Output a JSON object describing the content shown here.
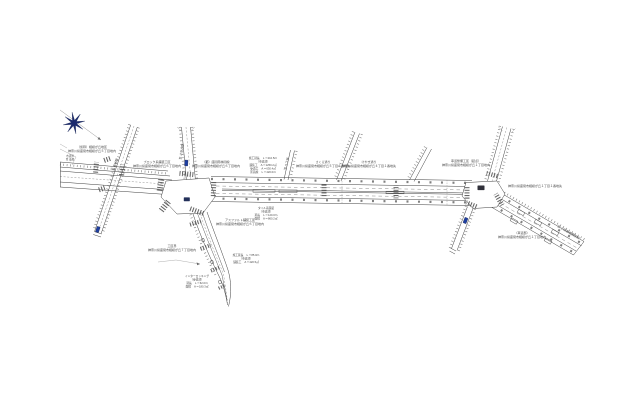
{
  "colors": {
    "background": "#ffffff",
    "line": "#3f3f3f",
    "navy": "#1b2a6e",
    "sign_blue": "#1e3fa0",
    "text": "#474747"
  },
  "compass": {
    "icon": "north-star-compass-icon"
  },
  "labels": [
    {
      "id": "plan-note-northwest",
      "x": 92,
      "y": 148,
      "lines": [
        "（仮称）相模が丘地区",
        "神奈川県座間市相模が丘５丁目地内"
      ]
    },
    {
      "id": "label-west-block",
      "x": 157,
      "y": 163,
      "lines": [
        "ブロック系舗装工区",
        "神奈川県座間市相模が丘６丁目地内"
      ]
    },
    {
      "id": "label-north-approach",
      "x": 216,
      "y": 163,
      "lines": [
        "（都）座間南林間線",
        "神奈川県座間市相模が丘６丁目地内"
      ]
    },
    {
      "id": "works-summary-center",
      "x": 263,
      "y": 159,
      "size": 2.7,
      "lines": [
        "施工延長　Ｌ＝210.5ｍ",
        "（車道部）",
        "舗装工　Ａ＝1250.2㎡",
        "歩道工　Ａ＝630.4㎡",
        "区画線　Ｌ＝420.0ｍ"
      ]
    },
    {
      "id": "label-branch-sakura",
      "x": 323,
      "y": 163,
      "lines": [
        "さくら通り",
        "神奈川県座間市相模が丘５丁目６番地先"
      ]
    },
    {
      "id": "label-branch-keyaki",
      "x": 369,
      "y": 163,
      "lines": [
        "けやき通り",
        "神奈川県座間市相模が丘４丁目１番地先"
      ]
    },
    {
      "id": "label-east-works",
      "x": 466,
      "y": 162,
      "lines": [
        "車道整備工区（起点）",
        "神奈川県座間市相模が丘１丁目地内"
      ]
    },
    {
      "id": "label-east-address",
      "x": 508,
      "y": 187,
      "anchor": "start",
      "lines": [
        "神奈川県座間市相模が丘１丁目１番地先"
      ]
    },
    {
      "id": "label-se-road",
      "x": 522,
      "y": 234,
      "lines": [
        "（車道部）",
        "神奈川県座間市相模が丘１丁目地内"
      ]
    },
    {
      "id": "dest-se",
      "x": 568,
      "y": 233,
      "rotate": 30,
      "lines": [
        "至 小田急相模原駅"
      ]
    },
    {
      "id": "label-ward-boundary",
      "x": 172,
      "y": 247,
      "lines": [
        "工区界",
        "神奈川県座間市相模が丘７丁目地内"
      ]
    },
    {
      "id": "works-summary-south-east",
      "x": 246,
      "y": 256,
      "size": 2.7,
      "lines": [
        "施工延長　Ｌ＝85.0ｍ",
        "（車道部）",
        "舗装工　Ａ＝420.5㎡"
      ]
    },
    {
      "id": "works-summary-south-west",
      "x": 197,
      "y": 277,
      "size": 2.7,
      "lines": [
        "インターロッキング",
        "（歩道部）",
        "延長　Ｌ＝62.0ｍ",
        "面積　Ａ＝180.3㎡"
      ]
    },
    {
      "id": "works-summary-below-road",
      "x": 266,
      "y": 209,
      "size": 2.7,
      "lines": [
        "タイル系舗装",
        "（車道部）",
        "延長　Ｌ＝120.0ｍ",
        "面積　Ａ＝860.2㎡"
      ]
    },
    {
      "id": "label-asphalt-works",
      "x": 240,
      "y": 221,
      "lines": [
        "アスファルト舗装工区",
        "神奈川県座間市相模が丘６丁目地内"
      ]
    },
    {
      "id": "dest-north-approach",
      "x": 182.5,
      "y": 152,
      "rotate": -80,
      "lines": [
        "至 さがみ野"
      ]
    },
    {
      "id": "dest-branch-1",
      "x": 287.5,
      "y": 164,
      "rotate": -77,
      "lines": [
        "至 ５丁目"
      ]
    },
    {
      "id": "dest-left-road",
      "x": 116,
      "y": 165,
      "rotate": -71,
      "lines": [
        "至 東林間"
      ]
    },
    {
      "id": "label-left-stub",
      "x": 70,
      "y": 157,
      "size": 2.6,
      "lines": [
        "市道界",
        "至 東原"
      ]
    }
  ],
  "markers": {
    "sign_posts": [
      {
        "x": 186.3,
        "y": 163,
        "rotate": 4
      },
      {
        "x": 97.8,
        "y": 229.5,
        "rotate": 19
      },
      {
        "x": 465.5,
        "y": 220.5,
        "rotate": 21
      }
    ],
    "signal_plates": [
      {
        "x": 186.8,
        "y": 199.3,
        "w": 6,
        "h": 3.8,
        "color": "#23305a"
      },
      {
        "x": 481,
        "y": 187.8,
        "w": 7,
        "h": 4.6,
        "color": "#30303a"
      }
    ]
  }
}
